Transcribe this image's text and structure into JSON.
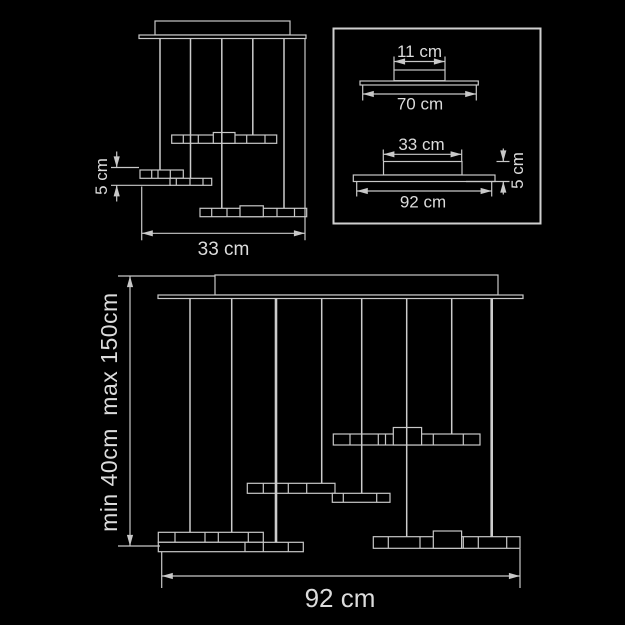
{
  "colors": {
    "background": "#000000",
    "line": "#c8c8c8",
    "text": "#dcdcdc"
  },
  "front_view_small": {
    "bar_offset_label": "5 cm",
    "width_label": "33 cm"
  },
  "detail_box": {
    "canopy_top_width_label": "11 cm",
    "canopy_width_label": "70 cm",
    "bar_top_width_label": "33 cm",
    "bar_width_label": "92 cm",
    "bar_height_label": "5 cm"
  },
  "front_view_large": {
    "suspension_max_label": "max 150cm",
    "suspension_min_label": "min 40cm",
    "width_label": "92 cm"
  }
}
